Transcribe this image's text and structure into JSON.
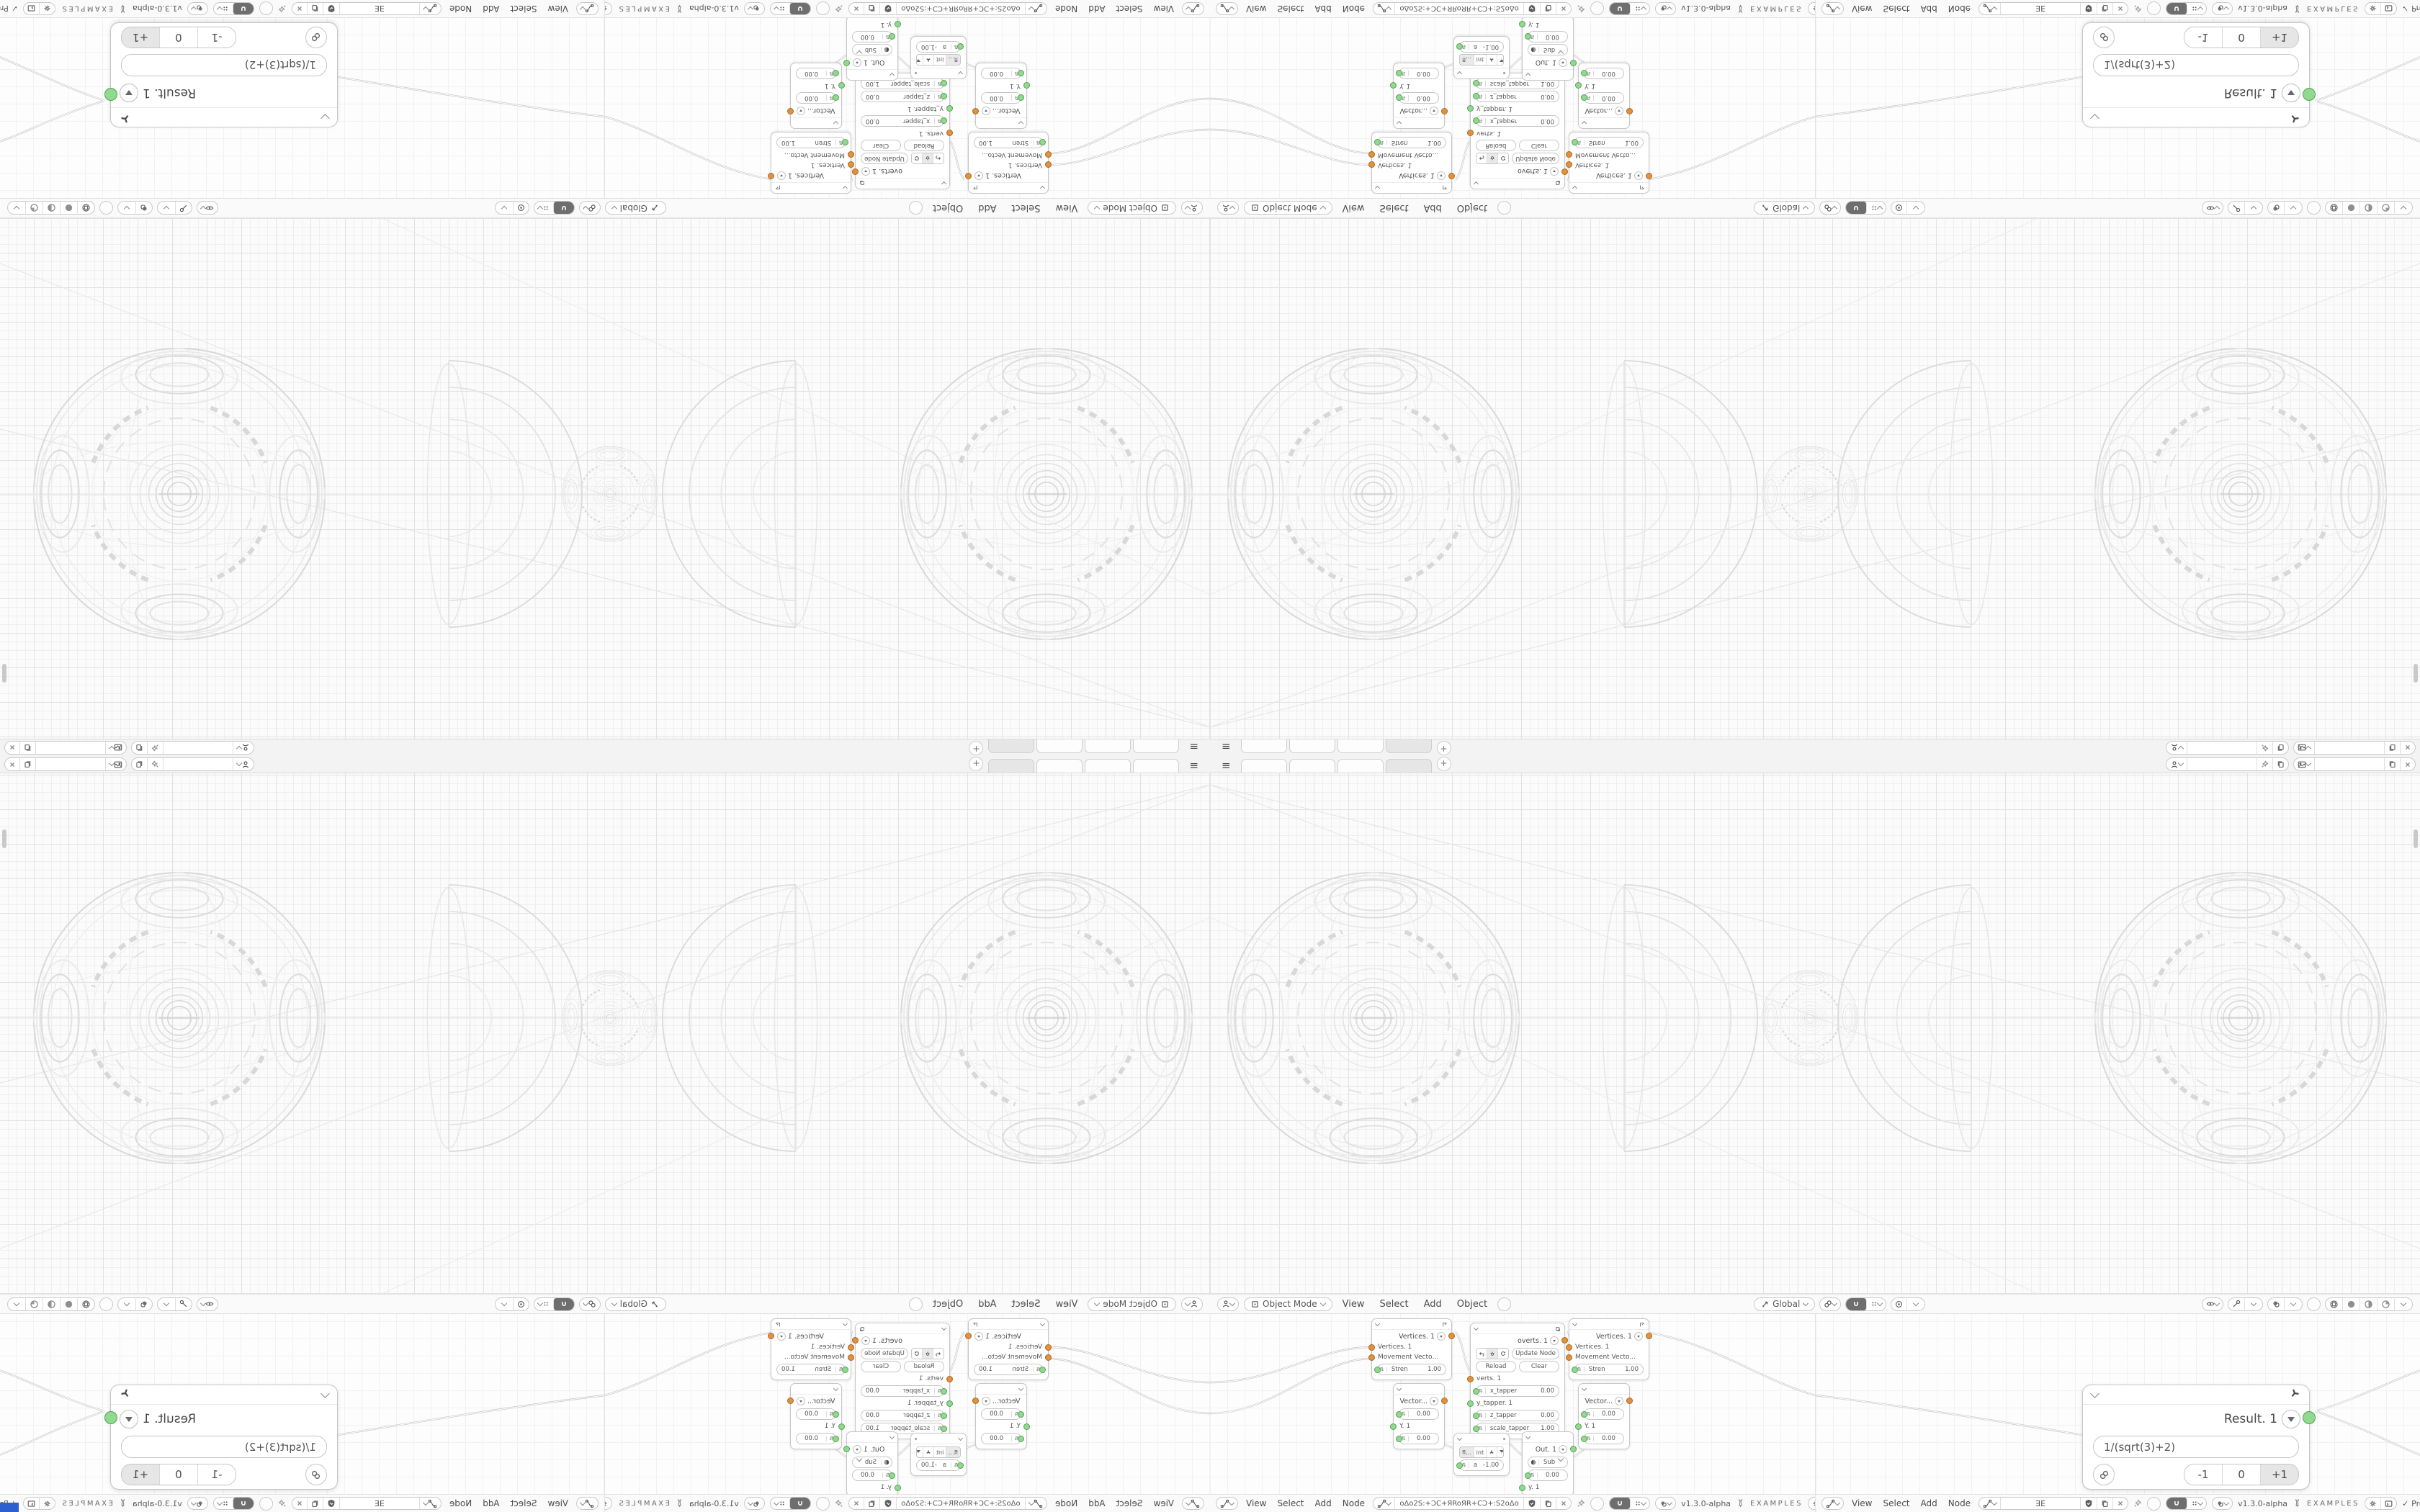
{
  "app": {
    "version": "v1.3.0-alpha",
    "examples": "EXAMPLES",
    "processing": "Processing",
    "check": "✓",
    "tab_add": "+",
    "hamburger": "≡"
  },
  "topbar": {
    "scene_value": "",
    "view_layer_value": ""
  },
  "viewport_header": {
    "mode": "Object Mode",
    "menu_view": "View",
    "menu_select": "Select",
    "menu_add": "Add",
    "menu_object": "Object",
    "orientation": "Global"
  },
  "editors": [
    {
      "menu_view": "View",
      "menu_select": "Select",
      "menu_add": "Add",
      "menu_node": "Node",
      "tree_name": "oΔo2S:+ƆC+ЯRoЯR+CƆ+:S2oΔo"
    },
    {
      "menu_view": "View",
      "menu_select": "Select",
      "menu_add": "Add",
      "menu_node": "Node",
      "tree_name": "ƎE"
    }
  ],
  "nodes": {
    "result": {
      "title": "Result. 1",
      "expression": "1/(sqrt(3)+2)",
      "dec": "-1",
      "zero": "0",
      "inc": "+1"
    },
    "vertices": {
      "title": "Vertices. 1",
      "in1": "Vertices. 1",
      "in2": "Movement Vecto...",
      "stren_label": "Stren",
      "stren_value": "1.00"
    },
    "vector": {
      "title": "Vector...",
      "f1": "0.00",
      "ylabel": "Y. 1",
      "f2": "0.00"
    },
    "overts": {
      "title": "overts. 1",
      "update": "Update Node",
      "reload": "Reload",
      "clear": "Clear",
      "verts": "verts. 1",
      "x_tapper": "x_tapper",
      "x_val": "0.00",
      "y_tapper": "y_tapper. 1",
      "z_tapper": "z_tapper",
      "z_val": "0.00",
      "scale_tapper": "scale_tapper",
      "scale_val": "1.00"
    },
    "math": {
      "opt1": "fl...",
      "opt2": "int",
      "a_label": "a",
      "a_val": "-1.00"
    },
    "out": {
      "title": "Out. 1",
      "op": "Sub",
      "val": "0.00",
      "ylabel": "y. 1"
    }
  },
  "colors": {
    "socket_green": "#8fd991",
    "socket_orange": "#e2913f",
    "wire": "#c5c5c5",
    "corner_blue": "#2e5fd0"
  }
}
